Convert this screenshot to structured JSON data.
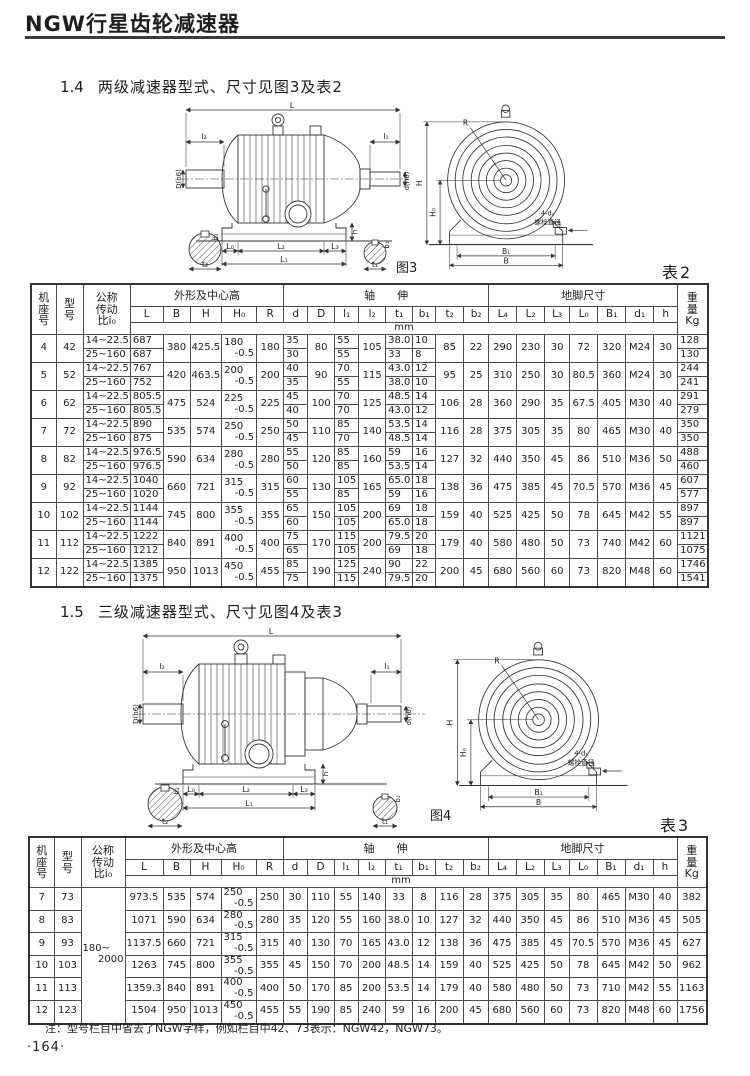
{
  "page": {
    "title": "NGW行星齿轮减速器",
    "note": "注：型号栏目中省去了NGW字样，例如栏目中42、73表示：NGW42，NGW73。",
    "page_number": "·164·"
  },
  "sec14": {
    "num": "1.4",
    "title": "两级减速器型式、尺寸见图3及表2"
  },
  "sec15": {
    "num": "1.5",
    "title": "三级减速器型式、尺寸见图4及表3"
  },
  "figure3": {
    "caption": "图3",
    "side": {
      "L": "L",
      "l2": "l₂",
      "l1": "l₁",
      "D": "D(h6)",
      "d": "d(h6)",
      "h": "h",
      "L0": "L₀",
      "L2": "L₂",
      "L3": "L₃",
      "L1": "L₁",
      "b2": "b₂",
      "t2": "t₂",
      "b1": "b₁",
      "t1": "t₁"
    },
    "front": {
      "R": "R",
      "H": "H",
      "H0": "H₀",
      "B1": "B₁",
      "B": "B",
      "bolt": "4-d₁",
      "bolt_note": "螺栓直径"
    }
  },
  "figure4": {
    "caption": "图4",
    "side": {
      "L": "L",
      "l2": "l₂",
      "l1": "l₁",
      "D": "D(h6)",
      "d": "d(h6)",
      "h": "h",
      "L0": "L₀",
      "L2": "L₂",
      "L3": "L₃",
      "L1": "L₁",
      "b2": "b₂",
      "t2": "t₂",
      "b1": "b₁",
      "t1": "t₁"
    },
    "front": {
      "R": "R",
      "H": "H",
      "H0": "H₀",
      "B1": "B₁",
      "B": "B",
      "bolt": "4-d₁",
      "bolt_note": "螺栓直径"
    }
  },
  "th": {
    "jizuo": "机\n座\n号",
    "xinghao": "型\n号",
    "ratio": "公称\n传动\n比i₀",
    "shape": "外形及中心高",
    "shaft": "轴　　伸",
    "foot": "地脚尺寸",
    "weight": "重\n量\nKg",
    "dims": [
      "L",
      "B",
      "H",
      "H₀",
      "R",
      "d",
      "D",
      "l₁",
      "l₂",
      "t₁",
      "b₁",
      "t₂",
      "b₂",
      "L₄",
      "L₂",
      "L₃",
      "L₀",
      "B₁",
      "d₁",
      "h"
    ],
    "unit": "mm"
  },
  "table2": {
    "caption": "表2",
    "groups": [
      {
        "jizuo": "4",
        "xinghao": "42",
        "sub": [
          {
            "ratio": "14~22.5",
            "L": "687",
            "d": "35",
            "l1": "55",
            "t1": "38.0",
            "b1": "10",
            "wt": "128"
          },
          {
            "ratio": "25~160",
            "L": "687",
            "d": "30",
            "l1": "55",
            "t1": "33",
            "b1": "8",
            "wt": "130"
          }
        ],
        "m": {
          "B": "380",
          "H": "425.5",
          "H0": "180",
          "H0tol": "-0.5",
          "R": "180",
          "D": "80",
          "l2": "105",
          "t2": "85",
          "b2": "22",
          "L4": "290",
          "L2": "230",
          "L3": "30",
          "L0": "72",
          "B1": "320",
          "d1": "M24",
          "h": "30"
        }
      },
      {
        "jizuo": "5",
        "xinghao": "52",
        "sub": [
          {
            "ratio": "14~22.5",
            "L": "767",
            "d": "40",
            "l1": "70",
            "t1": "43.0",
            "b1": "12",
            "wt": "244"
          },
          {
            "ratio": "25~160",
            "L": "752",
            "d": "35",
            "l1": "55",
            "t1": "38.0",
            "b1": "10",
            "wt": "241"
          }
        ],
        "m": {
          "B": "420",
          "H": "463.5",
          "H0": "200",
          "H0tol": "-0.5",
          "R": "200",
          "D": "90",
          "l2": "115",
          "t2": "95",
          "b2": "25",
          "L4": "310",
          "L2": "250",
          "L3": "30",
          "L0": "80.5",
          "B1": "360",
          "d1": "M24",
          "h": "30"
        }
      },
      {
        "jizuo": "6",
        "xinghao": "62",
        "sub": [
          {
            "ratio": "14~22.5",
            "L": "805.5",
            "d": "45",
            "l1": "70",
            "t1": "48.5",
            "b1": "14",
            "wt": "291"
          },
          {
            "ratio": "25~160",
            "L": "805.5",
            "d": "40",
            "l1": "70",
            "t1": "43.0",
            "b1": "12",
            "wt": "279"
          }
        ],
        "m": {
          "B": "475",
          "H": "524",
          "H0": "225",
          "H0tol": "-0.5",
          "R": "225",
          "D": "100",
          "l2": "125",
          "t2": "106",
          "b2": "28",
          "L4": "360",
          "L2": "290",
          "L3": "35",
          "L0": "67.5",
          "B1": "405",
          "d1": "M30",
          "h": "40"
        }
      },
      {
        "jizuo": "7",
        "xinghao": "72",
        "sub": [
          {
            "ratio": "14~22.5",
            "L": "890",
            "d": "50",
            "l1": "85",
            "t1": "53.5",
            "b1": "14",
            "wt": "350"
          },
          {
            "ratio": "25~160",
            "L": "875",
            "d": "45",
            "l1": "70",
            "t1": "48.5",
            "b1": "14",
            "wt": "350"
          }
        ],
        "m": {
          "B": "535",
          "H": "574",
          "H0": "250",
          "H0tol": "-0.5",
          "R": "250",
          "D": "110",
          "l2": "140",
          "t2": "116",
          "b2": "28",
          "L4": "375",
          "L2": "305",
          "L3": "35",
          "L0": "80",
          "B1": "465",
          "d1": "M30",
          "h": "40"
        }
      },
      {
        "jizuo": "8",
        "xinghao": "82",
        "sub": [
          {
            "ratio": "14~22.5",
            "L": "976.5",
            "d": "55",
            "l1": "85",
            "t1": "59",
            "b1": "16",
            "wt": "488"
          },
          {
            "ratio": "25~160",
            "L": "976.5",
            "d": "50",
            "l1": "85",
            "t1": "53.5",
            "b1": "14",
            "wt": "460"
          }
        ],
        "m": {
          "B": "590",
          "H": "634",
          "H0": "280",
          "H0tol": "-0.5",
          "R": "280",
          "D": "120",
          "l2": "160",
          "t2": "127",
          "b2": "32",
          "L4": "440",
          "L2": "350",
          "L3": "45",
          "L0": "86",
          "B1": "510",
          "d1": "M36",
          "h": "50"
        }
      },
      {
        "jizuo": "9",
        "xinghao": "92",
        "sub": [
          {
            "ratio": "14~22.5",
            "L": "1040",
            "d": "60",
            "l1": "105",
            "t1": "65.0",
            "b1": "18",
            "wt": "607"
          },
          {
            "ratio": "25~160",
            "L": "1020",
            "d": "55",
            "l1": "85",
            "t1": "59",
            "b1": "16",
            "wt": "577"
          }
        ],
        "m": {
          "B": "660",
          "H": "721",
          "H0": "315",
          "H0tol": "-0.5",
          "R": "315",
          "D": "130",
          "l2": "165",
          "t2": "138",
          "b2": "36",
          "L4": "475",
          "L2": "385",
          "L3": "45",
          "L0": "70.5",
          "B1": "570",
          "d1": "M36",
          "h": "45"
        }
      },
      {
        "jizuo": "10",
        "xinghao": "102",
        "sub": [
          {
            "ratio": "14~22.5",
            "L": "1144",
            "d": "65",
            "l1": "105",
            "t1": "69",
            "b1": "18",
            "wt": "897"
          },
          {
            "ratio": "25~160",
            "L": "1144",
            "d": "60",
            "l1": "105",
            "t1": "65.0",
            "b1": "18",
            "wt": "897"
          }
        ],
        "m": {
          "B": "745",
          "H": "800",
          "H0": "355",
          "H0tol": "-0.5",
          "R": "355",
          "D": "150",
          "l2": "200",
          "t2": "159",
          "b2": "40",
          "L4": "525",
          "L2": "425",
          "L3": "50",
          "L0": "78",
          "B1": "645",
          "d1": "M42",
          "h": "55"
        }
      },
      {
        "jizuo": "11",
        "xinghao": "112",
        "sub": [
          {
            "ratio": "14~22.5",
            "L": "1222",
            "d": "75",
            "l1": "115",
            "t1": "79.5",
            "b1": "20",
            "wt": "1121"
          },
          {
            "ratio": "25~160",
            "L": "1212",
            "d": "65",
            "l1": "105",
            "t1": "69",
            "b1": "18",
            "wt": "1075"
          }
        ],
        "m": {
          "B": "840",
          "H": "891",
          "H0": "400",
          "H0tol": "-0.5",
          "R": "400",
          "D": "170",
          "l2": "200",
          "t2": "179",
          "b2": "40",
          "L4": "580",
          "L2": "480",
          "L3": "50",
          "L0": "73",
          "B1": "740",
          "d1": "M42",
          "h": "60"
        }
      },
      {
        "jizuo": "12",
        "xinghao": "122",
        "sub": [
          {
            "ratio": "14~22.5",
            "L": "1385",
            "d": "85",
            "l1": "125",
            "t1": "90",
            "b1": "22",
            "wt": "1746"
          },
          {
            "ratio": "25~160",
            "L": "1375",
            "d": "75",
            "l1": "115",
            "t1": "79.5",
            "b1": "20",
            "wt": "1541"
          }
        ],
        "m": {
          "B": "950",
          "H": "1013",
          "H0": "450",
          "H0tol": "-0.5",
          "R": "455",
          "D": "190",
          "l2": "240",
          "t2": "200",
          "b2": "45",
          "L4": "680",
          "L2": "560",
          "L3": "60",
          "L0": "73",
          "B1": "820",
          "d1": "M48",
          "h": "60"
        }
      }
    ]
  },
  "table3": {
    "caption": "表3",
    "ratio_lines": [
      "180~",
      "2000"
    ],
    "rows": [
      {
        "jizuo": "7",
        "xinghao": "73",
        "L": "973.5",
        "B": "535",
        "H": "574",
        "H0": "250",
        "H0tol": "-0.5",
        "R": "250",
        "d": "30",
        "D": "110",
        "l1": "55",
        "l2": "140",
        "t1": "33",
        "b1": "8",
        "t2": "116",
        "b2": "28",
        "L4": "375",
        "L2": "305",
        "L3": "35",
        "L0": "80",
        "B1": "465",
        "d1": "M30",
        "h": "40",
        "wt": "382"
      },
      {
        "jizuo": "8",
        "xinghao": "83",
        "L": "1071",
        "B": "590",
        "H": "634",
        "H0": "280",
        "H0tol": "-0.5",
        "R": "280",
        "d": "35",
        "D": "120",
        "l1": "55",
        "l2": "160",
        "t1": "38.0",
        "b1": "10",
        "t2": "127",
        "b2": "32",
        "L4": "440",
        "L2": "350",
        "L3": "45",
        "L0": "86",
        "B1": "510",
        "d1": "M36",
        "h": "45",
        "wt": "505"
      },
      {
        "jizuo": "9",
        "xinghao": "93",
        "L": "1137.5",
        "B": "660",
        "H": "721",
        "H0": "315",
        "H0tol": "-0.5",
        "R": "315",
        "d": "40",
        "D": "130",
        "l1": "70",
        "l2": "165",
        "t1": "43.0",
        "b1": "12",
        "t2": "138",
        "b2": "36",
        "L4": "475",
        "L2": "385",
        "L3": "45",
        "L0": "70.5",
        "B1": "570",
        "d1": "M36",
        "h": "45",
        "wt": "627"
      },
      {
        "jizuo": "10",
        "xinghao": "103",
        "L": "1263",
        "B": "745",
        "H": "800",
        "H0": "355",
        "H0tol": "-0.5",
        "R": "355",
        "d": "45",
        "D": "150",
        "l1": "70",
        "l2": "200",
        "t1": "48.5",
        "b1": "14",
        "t2": "159",
        "b2": "40",
        "L4": "525",
        "L2": "425",
        "L3": "50",
        "L0": "78",
        "B1": "645",
        "d1": "M42",
        "h": "50",
        "wt": "962"
      },
      {
        "jizuo": "11",
        "xinghao": "113",
        "L": "1359.3",
        "B": "840",
        "H": "891",
        "H0": "400",
        "H0tol": "-0.5",
        "R": "400",
        "d": "50",
        "D": "170",
        "l1": "85",
        "l2": "200",
        "t1": "53.5",
        "b1": "14",
        "t2": "179",
        "b2": "40",
        "L4": "580",
        "L2": "480",
        "L3": "50",
        "L0": "73",
        "B1": "710",
        "d1": "M42",
        "h": "55",
        "wt": "1163"
      },
      {
        "jizuo": "12",
        "xinghao": "123",
        "L": "1504",
        "B": "950",
        "H": "1013",
        "H0": "450",
        "H0tol": "-0.5",
        "R": "455",
        "d": "55",
        "D": "190",
        "l1": "85",
        "l2": "240",
        "t1": "59",
        "b1": "16",
        "t2": "200",
        "b2": "45",
        "L4": "680",
        "L2": "560",
        "L3": "60",
        "L0": "73",
        "B1": "820",
        "d1": "M48",
        "h": "60",
        "wt": "1756"
      }
    ]
  }
}
